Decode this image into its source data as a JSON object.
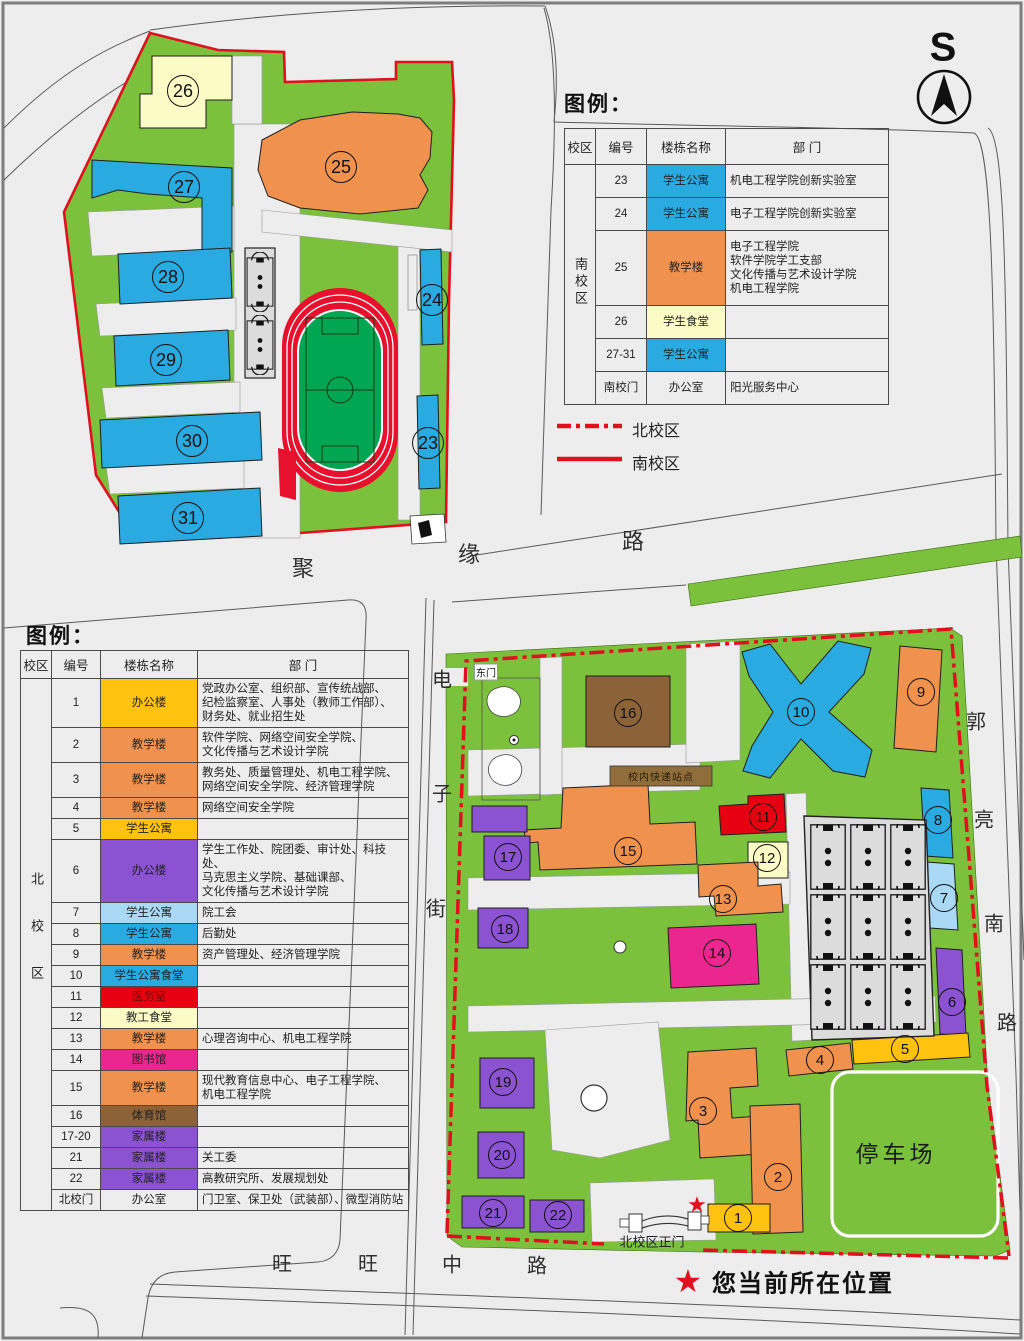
{
  "colors": {
    "green": "#7cc13c",
    "field": "#00a651",
    "red_line": "#e0101f",
    "blue": "#29abe2",
    "lightblue": "#a9d9f5",
    "orange": "#f0924e",
    "gold": "#ffc20e",
    "lightyellow": "#fbfbc6",
    "purple": "#8b52d1",
    "red": "#e60012",
    "magenta": "#ec268f",
    "brown": "#8c6239",
    "road": "#ededed",
    "court": "#dcdcdc",
    "express": "#8f6e3c",
    "none": "transparent"
  },
  "compass": {
    "label": "S"
  },
  "roads": {
    "juyuan": [
      "聚",
      "缘",
      "路"
    ],
    "dianzi": [
      "电",
      "子",
      "街"
    ],
    "guoliang": [
      "郭",
      "亮",
      "南",
      "路"
    ],
    "wangwang": [
      "旺",
      "旺",
      "中",
      "路"
    ]
  },
  "map_texts": {
    "east_gate": "东门",
    "express_station": "校内快递站点",
    "parking": "停车场",
    "north_gate": "北校区正门"
  },
  "current_location": {
    "symbol": "★",
    "label": "您当前所在位置"
  },
  "legend_lines": [
    {
      "style": "dashdot",
      "label": "北校区"
    },
    {
      "style": "solid",
      "label": "南校区"
    }
  ],
  "legend_south": {
    "title": "图例：",
    "headers": [
      "校区",
      "编号",
      "楼栋名称",
      "部 门"
    ],
    "campus": "南校区",
    "rows": [
      {
        "no": "23",
        "name": "学生公寓",
        "color": "blue",
        "dept": "机电工程学院创新实验室"
      },
      {
        "no": "24",
        "name": "学生公寓",
        "color": "blue",
        "dept": "电子工程学院创新实验室"
      },
      {
        "no": "25",
        "name": "教学楼",
        "color": "orange",
        "dept": "电子工程学院\n软件学院学工支部\n文化传播与艺术设计学院\n机电工程学院"
      },
      {
        "no": "26",
        "name": "学生食堂",
        "color": "lightyellow",
        "dept": ""
      },
      {
        "no": "27-31",
        "name": "学生公寓",
        "color": "blue",
        "dept": ""
      },
      {
        "no": "南校门",
        "name": "办公室",
        "color": "none",
        "dept": "阳光服务中心"
      }
    ]
  },
  "legend_north": {
    "title": "图例：",
    "headers": [
      "校区",
      "编号",
      "楼栋名称",
      "部 门"
    ],
    "campus": "北校区",
    "rows": [
      {
        "no": "1",
        "name": "办公楼",
        "color": "gold",
        "dept": "党政办公室、组织部、宣传统战部、\n纪检监察室、人事处（教师工作部）、\n财务处、就业招生处"
      },
      {
        "no": "2",
        "name": "教学楼",
        "color": "orange",
        "dept": "软件学院、网络空间安全学院、\n文化传播与艺术设计学院"
      },
      {
        "no": "3",
        "name": "教学楼",
        "color": "orange",
        "dept": "教务处、质量管理处、机电工程学院、\n网络空间安全学院、经济管理学院"
      },
      {
        "no": "4",
        "name": "教学楼",
        "color": "orange",
        "dept": "网络空间安全学院"
      },
      {
        "no": "5",
        "name": "学生公寓",
        "color": "gold",
        "dept": ""
      },
      {
        "no": "6",
        "name": "办公楼",
        "color": "purple",
        "dept": "学生工作处、院团委、审计处、科技处、\n马克思主义学院、基础课部、\n文化传播与艺术设计学院"
      },
      {
        "no": "7",
        "name": "学生公寓",
        "color": "lightblue",
        "dept": "院工会"
      },
      {
        "no": "8",
        "name": "学生公寓",
        "color": "blue",
        "dept": "后勤处"
      },
      {
        "no": "9",
        "name": "教学楼",
        "color": "orange",
        "dept": "资产管理处、经济管理学院"
      },
      {
        "no": "10",
        "name": "学生公寓食堂",
        "color": "blue",
        "dept": ""
      },
      {
        "no": "11",
        "name": "医务室",
        "color": "red",
        "dept": ""
      },
      {
        "no": "12",
        "name": "教工食堂",
        "color": "lightyellow",
        "dept": ""
      },
      {
        "no": "13",
        "name": "教学楼",
        "color": "orange",
        "dept": "心理咨询中心、机电工程学院"
      },
      {
        "no": "14",
        "name": "图书馆",
        "color": "magenta",
        "dept": ""
      },
      {
        "no": "15",
        "name": "教学楼",
        "color": "orange",
        "dept": "现代教育信息中心、电子工程学院、\n机电工程学院"
      },
      {
        "no": "16",
        "name": "体育馆",
        "color": "brown",
        "dept": ""
      },
      {
        "no": "17-20",
        "name": "家属楼",
        "color": "purple",
        "dept": ""
      },
      {
        "no": "21",
        "name": "家属楼",
        "color": "purple",
        "dept": "关工委"
      },
      {
        "no": "22",
        "name": "家属楼",
        "color": "purple",
        "dept": "高教研究所、发展规划处"
      },
      {
        "no": "北校门",
        "name": "办公室",
        "color": "none",
        "dept": "门卫室、保卫处（武装部）、微型消防站"
      }
    ]
  },
  "south_campus": {
    "badges": [
      {
        "n": "26",
        "x": 183,
        "y": 91
      },
      {
        "n": "25",
        "x": 341,
        "y": 167
      },
      {
        "n": "27",
        "x": 184,
        "y": 187
      },
      {
        "n": "28",
        "x": 168,
        "y": 277
      },
      {
        "n": "29",
        "x": 166,
        "y": 360
      },
      {
        "n": "30",
        "x": 192,
        "y": 441
      },
      {
        "n": "31",
        "x": 188,
        "y": 518
      },
      {
        "n": "24",
        "x": 432,
        "y": 300
      },
      {
        "n": "23",
        "x": 428,
        "y": 443
      }
    ]
  },
  "north_campus": {
    "badges": [
      {
        "n": "16",
        "x": 628,
        "y": 713
      },
      {
        "n": "10",
        "x": 801,
        "y": 712
      },
      {
        "n": "9",
        "x": 921,
        "y": 692
      },
      {
        "n": "8",
        "x": 938,
        "y": 820
      },
      {
        "n": "7",
        "x": 944,
        "y": 898
      },
      {
        "n": "6",
        "x": 952,
        "y": 1002
      },
      {
        "n": "5",
        "x": 905,
        "y": 1049
      },
      {
        "n": "4",
        "x": 820,
        "y": 1060
      },
      {
        "n": "11",
        "x": 763,
        "y": 817
      },
      {
        "n": "12",
        "x": 767,
        "y": 858
      },
      {
        "n": "13",
        "x": 723,
        "y": 899
      },
      {
        "n": "15",
        "x": 628,
        "y": 851
      },
      {
        "n": "14",
        "x": 717,
        "y": 953
      },
      {
        "n": "17",
        "x": 508,
        "y": 857
      },
      {
        "n": "18",
        "x": 505,
        "y": 929
      },
      {
        "n": "19",
        "x": 503,
        "y": 1082
      },
      {
        "n": "20",
        "x": 502,
        "y": 1155
      },
      {
        "n": "21",
        "x": 493,
        "y": 1213
      },
      {
        "n": "22",
        "x": 558,
        "y": 1215
      },
      {
        "n": "3",
        "x": 703,
        "y": 1111
      },
      {
        "n": "2",
        "x": 778,
        "y": 1177
      },
      {
        "n": "1",
        "x": 738,
        "y": 1218
      }
    ]
  }
}
